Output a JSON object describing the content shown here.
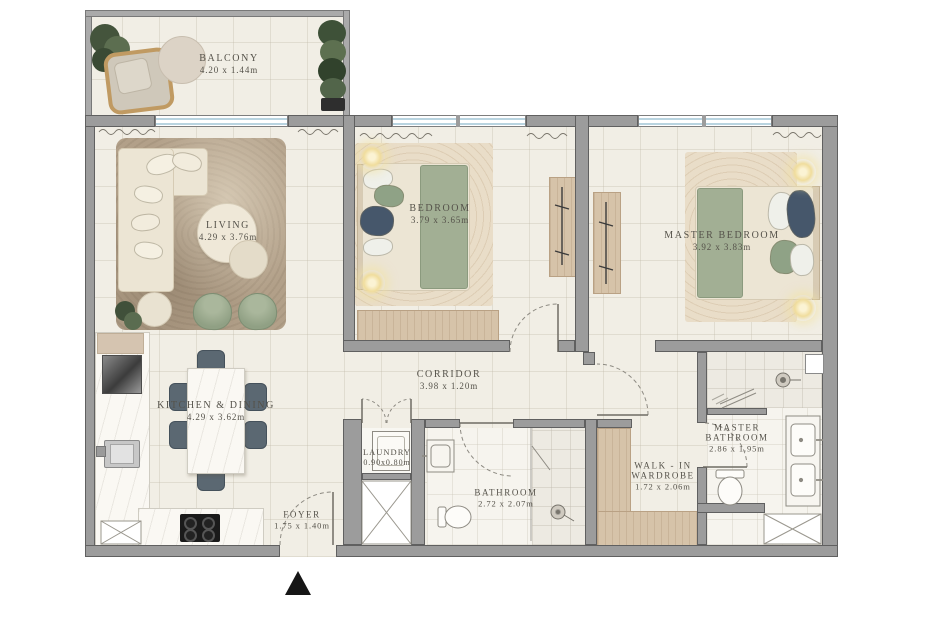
{
  "plan_type": "apartment-floor-plan",
  "rooms": {
    "balcony": {
      "name": "BALCONY",
      "dims": "4.20 x 1.44m"
    },
    "living": {
      "name": "LIVING",
      "dims": "4.29 x 3.76m"
    },
    "bedroom": {
      "name": "BEDROOM",
      "dims": "3.79 x 3.65m"
    },
    "master_bedroom": {
      "name": "MASTER BEDROOM",
      "dims": "3.92 x 3.83m"
    },
    "kitchen": {
      "name": "KITCHEN & DINING",
      "dims": "4.29 x 3.62m"
    },
    "corridor": {
      "name": "CORRIDOR",
      "dims": "3.98 x 1.20m"
    },
    "laundry": {
      "name": "LAUNDRY",
      "dims": "0.90x0.80m"
    },
    "bathroom": {
      "name": "BATHROOM",
      "dims": "2.72 x 2.07m"
    },
    "walk_in": {
      "line1": "WALK - IN",
      "line2": "WARDROBE",
      "dims": "1.72 x 2.06m"
    },
    "master_bathroom": {
      "line1": "MASTER",
      "line2": "BATHROOM",
      "dims": "2.86 x 1.95m"
    },
    "foyer": {
      "name": "FOYER",
      "dims": "1.75 x 1.40m"
    }
  },
  "colors": {
    "wall": "#9c9c9c",
    "wall_edge": "#606060",
    "floor": "#f1eee5",
    "window_glass": "#b9d4e0",
    "wood": "#d6c3a9",
    "text": "#55524a",
    "accent_green": "#96a489",
    "chair_slate": "#5b6872",
    "rug_living": "#b2a089",
    "rug_bed": "#e9ddc8",
    "linen_cream": "#ece5d4",
    "entrance_marker": "#161616"
  }
}
